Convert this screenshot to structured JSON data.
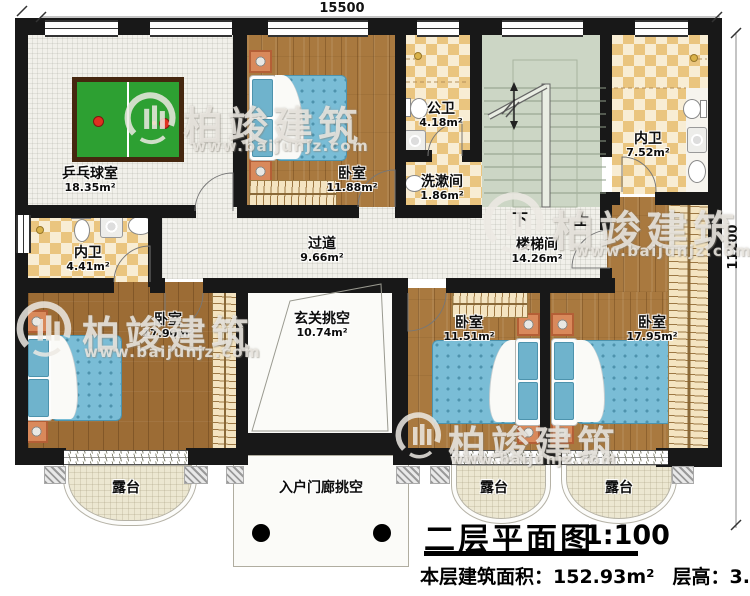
{
  "dimensions": {
    "top": "15500",
    "right": "11200"
  },
  "rooms": {
    "pingpong": {
      "name": "乒乓球室",
      "area": "18.35m²"
    },
    "bedroom_top": {
      "name": "卧室",
      "area": "11.88m²"
    },
    "public_bath": {
      "name": "公卫",
      "area": "4.18m²"
    },
    "washroom": {
      "name": "洗漱间",
      "area": "1.86m²"
    },
    "ensuite_right": {
      "name": "内卫",
      "area": "7.52m²"
    },
    "ensuite_left": {
      "name": "内卫",
      "area": "4.41m²"
    },
    "corridor": {
      "name": "过道",
      "area": "9.66m²"
    },
    "stairwell": {
      "name": "楼梯间",
      "area": "14.26m²"
    },
    "foyer_void": {
      "name": "玄关挑空",
      "area": "10.74m²"
    },
    "bedroom_left": {
      "name": "卧室",
      "area": "17.90m²"
    },
    "bedroom_mid": {
      "name": "卧室",
      "area": "11.51m²"
    },
    "bedroom_right": {
      "name": "卧室",
      "area": "17.95m²"
    },
    "terrace_left": {
      "name": "露台"
    },
    "terrace_mid": {
      "name": "露台"
    },
    "terrace_right": {
      "name": "露台"
    },
    "porch_void": {
      "name": "入户门廊挑空"
    }
  },
  "stairs": {
    "down": "下",
    "up": "上"
  },
  "title": {
    "main": "二层平面图",
    "scale": "1:100",
    "area_label": "本层建筑面积：",
    "area_value": "152.93m²",
    "height_label": "层高：",
    "height_value": "3.3m"
  },
  "watermark": {
    "brand": "柏竣建筑",
    "url": "www.baijunjz.com"
  }
}
